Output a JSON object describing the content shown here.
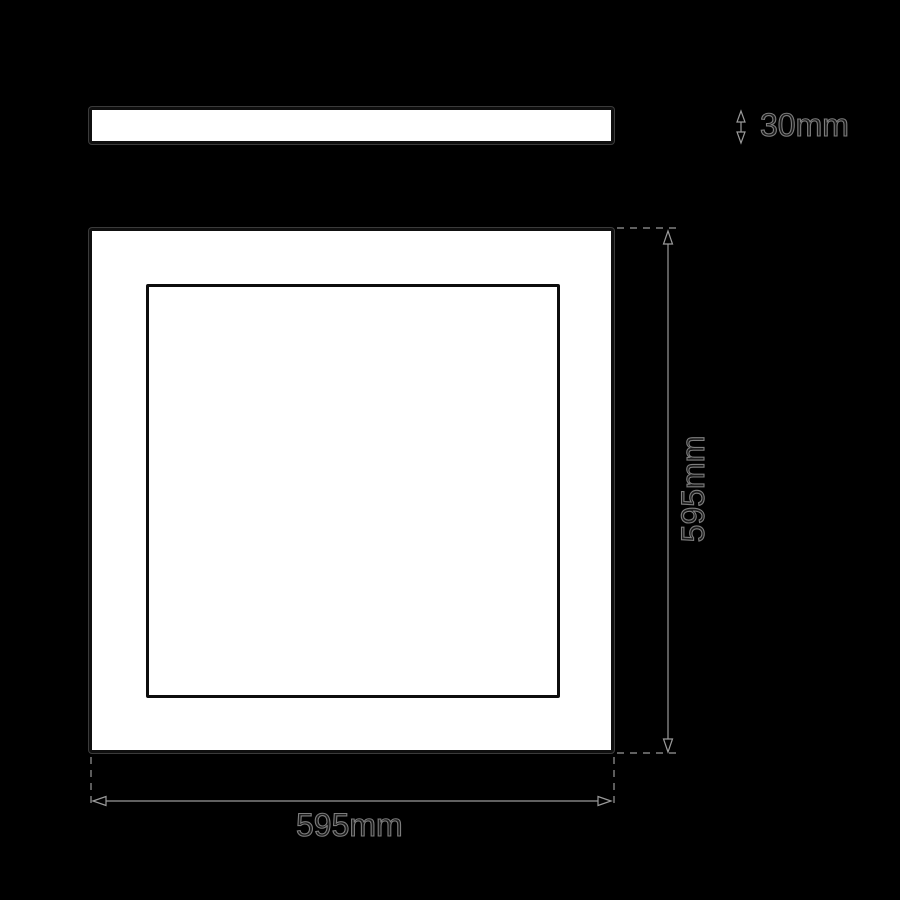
{
  "drawing": {
    "type": "technical-dimension-drawing",
    "labels": {
      "thickness": "30mm",
      "width": "595mm",
      "height": "595mm"
    },
    "colors": {
      "background": "#000000",
      "panel_fill": "#ffffff",
      "panel_outline": "#0f0f0f",
      "dimension_stroke": "#9a9a9a",
      "text_fill": "#1a1a1a",
      "text_outline": "#7d7d7d"
    }
  }
}
